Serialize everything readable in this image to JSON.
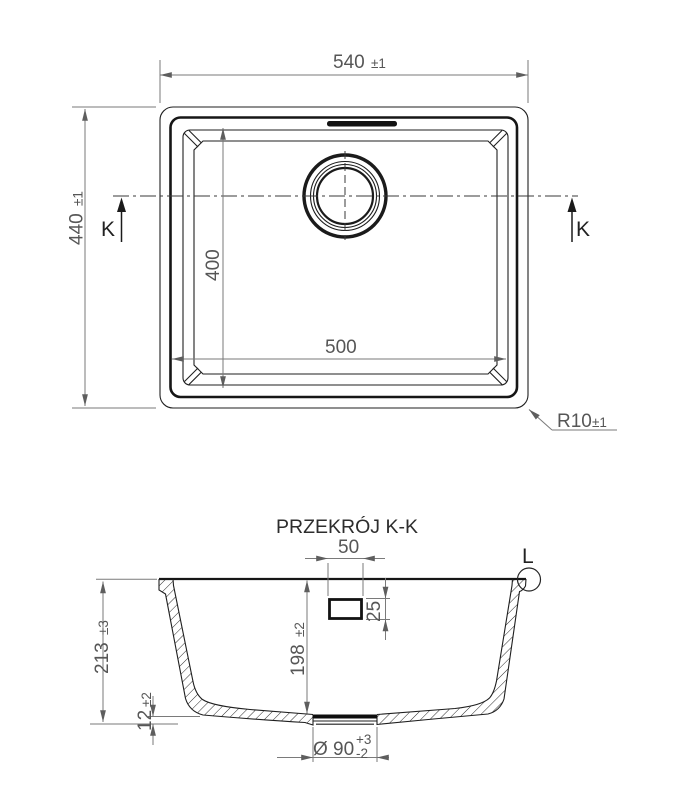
{
  "colors": {
    "line": "#1f1f1f",
    "dimension_line": "#7a7a7a",
    "dimension_text": "#565656",
    "background": "#ffffff"
  },
  "top_view": {
    "width_dim": {
      "value": "540",
      "tol": "±1"
    },
    "height_dim": {
      "value": "440",
      "tol": "±1"
    },
    "bowl_width_dim": {
      "value": "500"
    },
    "bowl_height_dim": {
      "value": "400"
    },
    "corner_radius_dim": {
      "value": "R10",
      "tol": "±1"
    },
    "section_marker_left": "K",
    "section_marker_right": "K"
  },
  "section_view": {
    "title": "PRZEKRÓJ K-K",
    "overall_height_dim": {
      "value": "213",
      "tol": "±3"
    },
    "depth_dim": {
      "value": "198",
      "tol": "±2"
    },
    "base_thickness_dim": {
      "value": "12",
      "tol": "±2"
    },
    "overflow_width_dim": {
      "value": "50"
    },
    "overflow_height_dim": {
      "value": "25"
    },
    "drain_dim": {
      "value": "Ø 90",
      "tol_plus": "+3",
      "tol_minus": "-2"
    },
    "detail_marker": "L"
  }
}
